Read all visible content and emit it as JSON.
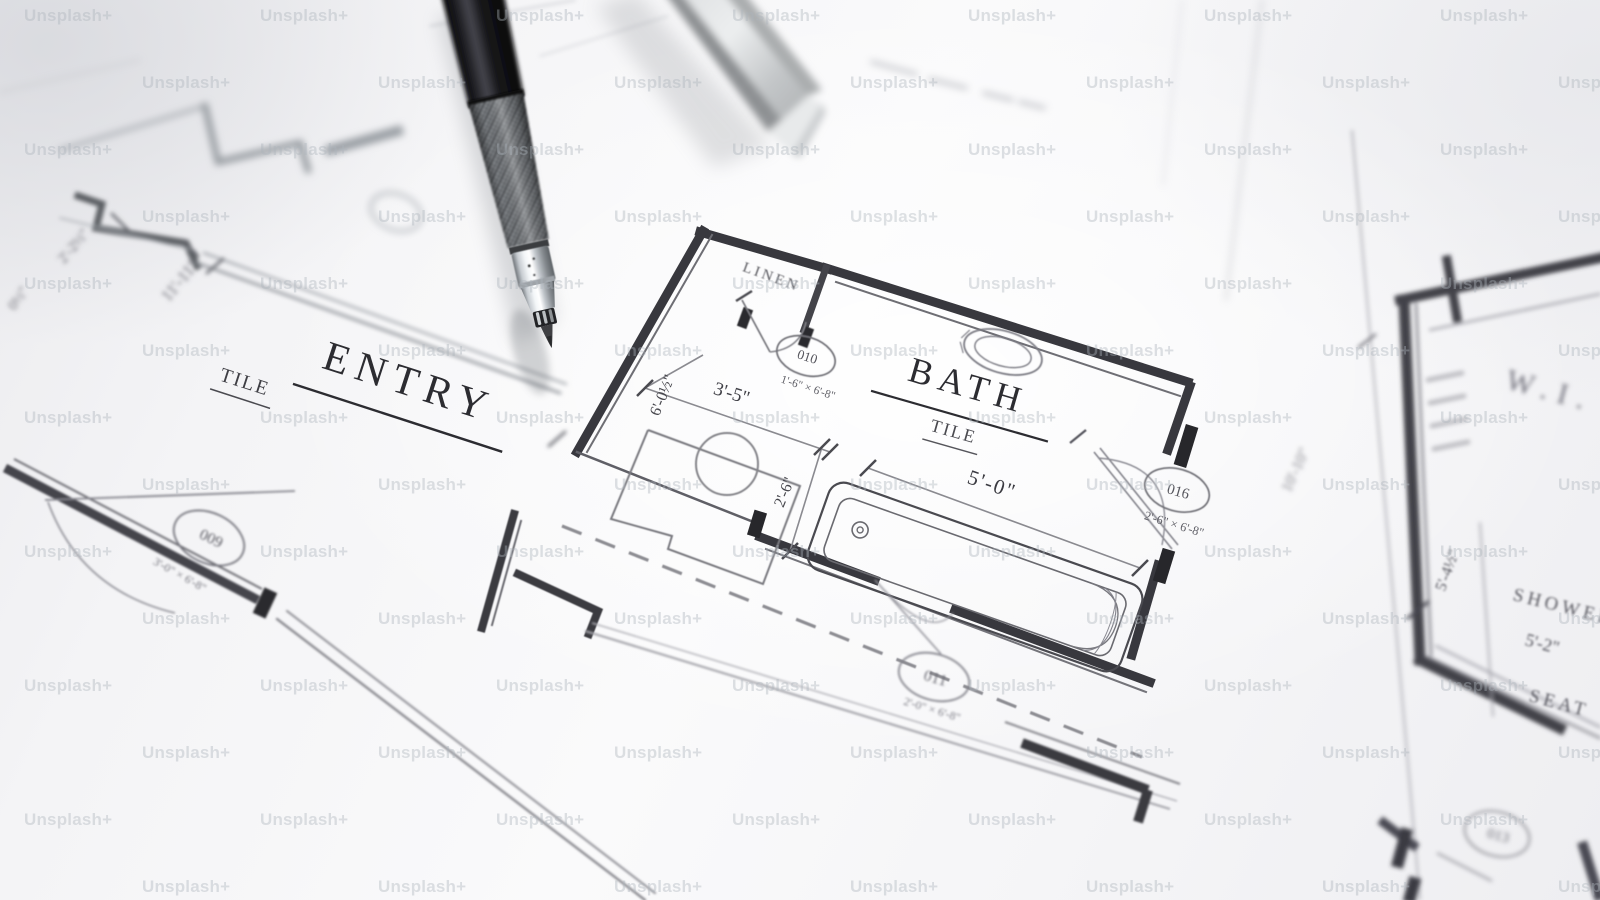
{
  "image": {
    "description": "Photograph of an architectural floor plan blueprint with a mechanical drafting pencil and metal scale ruler",
    "watermark": "Unsplash+"
  },
  "plan": {
    "rooms": {
      "entry": {
        "name": "ENTRY",
        "finish": "TILE"
      },
      "bath": {
        "name": "BATH",
        "finish": "TILE"
      },
      "linen": {
        "name": "LINEN"
      },
      "walk_in": {
        "name": "W.I."
      },
      "shower": {
        "name": "SHOWER",
        "seat": "SEAT"
      }
    },
    "door_tags": {
      "t009": {
        "id": "009",
        "size": "3'-0\" × 6'-8\""
      },
      "t010": {
        "id": "010",
        "size": "1'-6\" × 6'-8\""
      },
      "t011": {
        "id": "011",
        "size": "2'-0\" × 6'-8\""
      },
      "t013": {
        "id": "013"
      },
      "t016": {
        "id": "016",
        "size": "2'-6\" × 6'-8\""
      }
    },
    "dimensions": {
      "hall": "11'-11\"",
      "jog": "2'-2½\"",
      "edge_partial": "0½\"",
      "vanity_depth": "6'-0½\"",
      "vanity_width": "3'-5\"",
      "tub_width": "2'-6\"",
      "tub_length": "5'-0\"",
      "closet_length": "10'-10\"",
      "shower_depth": "5'-4½\"",
      "shower_width": "5'-2\""
    }
  }
}
